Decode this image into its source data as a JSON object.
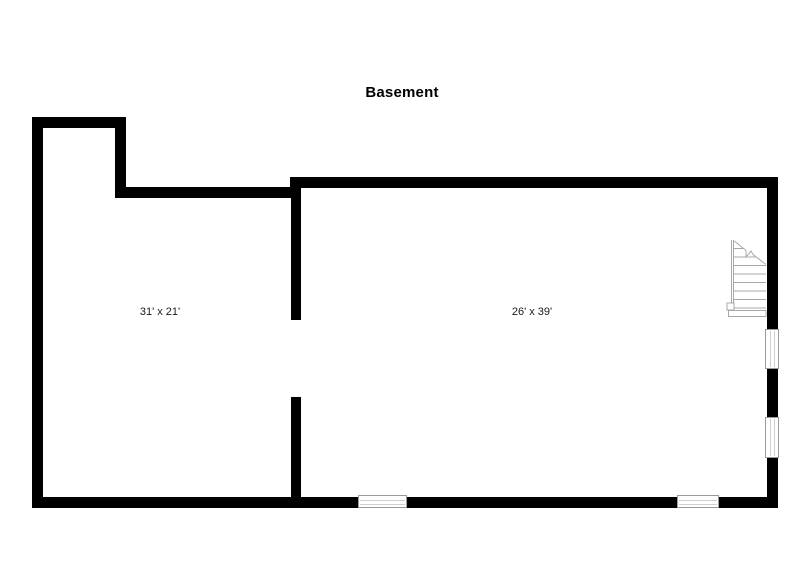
{
  "title": "Basement",
  "rooms": [
    {
      "id": "left-room",
      "dimensions": "31' x 21'"
    },
    {
      "id": "right-room",
      "dimensions": "26' x 39'"
    }
  ],
  "icons": {
    "staircase": "staircase-icon",
    "windows": [
      "window-bottom-left",
      "window-bottom-right",
      "window-right-upper",
      "window-right-lower"
    ]
  },
  "colors": {
    "wall": "#000000",
    "background": "#ffffff",
    "stair_outline": "#a8a8a8",
    "window_border": "#9a9a9a",
    "window_glass_line": "#cfcfcf",
    "text": "#000000"
  }
}
